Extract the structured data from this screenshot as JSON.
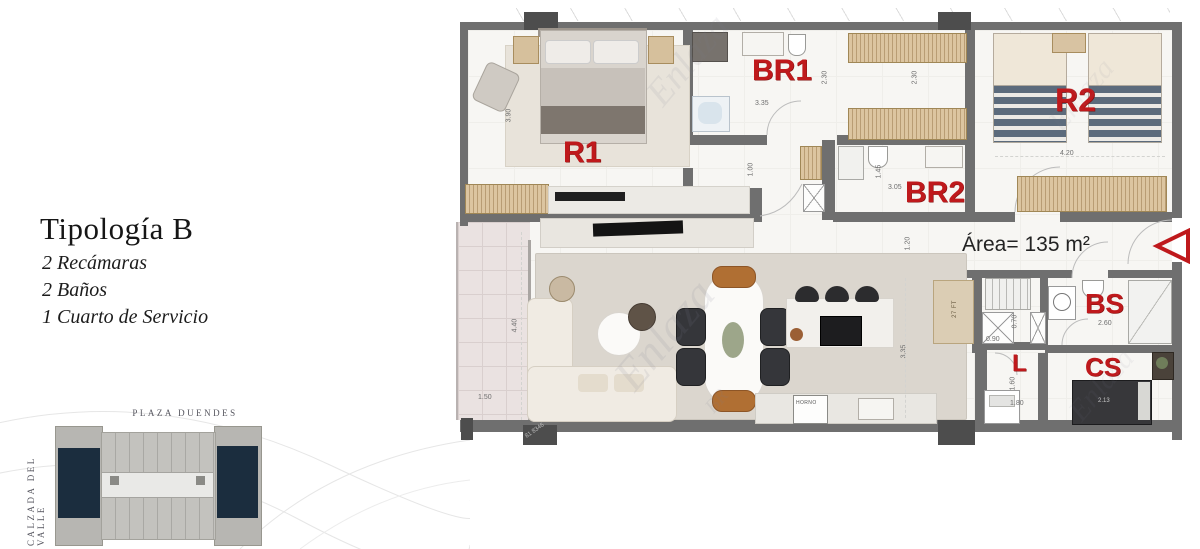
{
  "typology": {
    "title": "Tipología B",
    "features": [
      "2 Recámaras",
      "2 Baños",
      "1 Cuarto de Servicio"
    ]
  },
  "key_plan": {
    "top_street": "PLAZA DUENDES",
    "left_street": "CALZADA DEL VALLE"
  },
  "plan": {
    "area_text": "Área= 135 m²",
    "room_labels": {
      "r1": "R1",
      "br1": "BR1",
      "br2": "BR2",
      "r2": "R2",
      "bs": "BS",
      "cs": "CS",
      "laundry": "L"
    },
    "dimensions": {
      "r1_depth": "3.90",
      "br1_width": "3.35",
      "br1_depth": "2.30",
      "closet_depth": "2.30",
      "r2_width": "4.20",
      "hall_width": "1.00",
      "br2_depth": "1.45",
      "br2_width": "3.05",
      "entry_depth": "1.20",
      "terrace_depth": "4.40",
      "terrace_width": "1.50",
      "kitchen_depth": "3.35",
      "shaft_width": "0.90",
      "shaft_depth": "0.70",
      "bs_width": "2.60",
      "laundry_depth": "1.60",
      "laundry_width": "1.80",
      "cs_bed_width": "2.13"
    },
    "appliances": {
      "oven": "HORNO",
      "fridge": "27 FT"
    }
  },
  "watermark": {
    "brand": "Enlaza",
    "sub": "BR",
    "phone_fragment": "81 8346"
  },
  "colors": {
    "accent_red": "#bf191c",
    "wall_gray": "#6f6f6f",
    "highlight_navy": "#1b2d3e"
  }
}
